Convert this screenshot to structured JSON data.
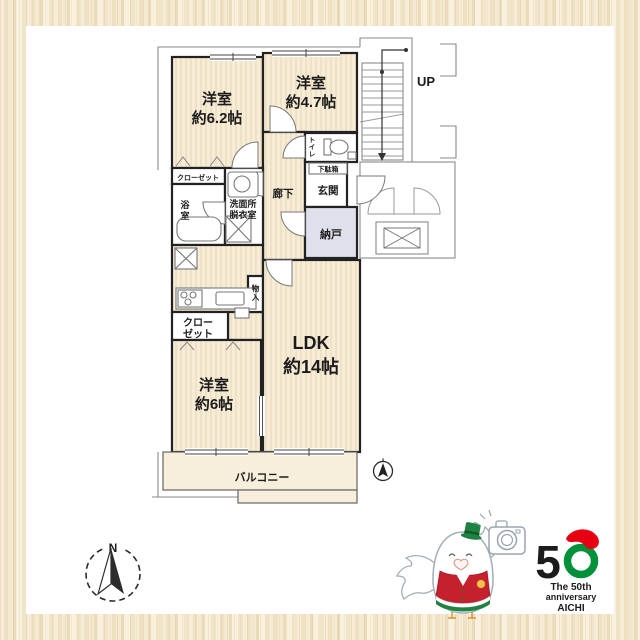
{
  "plan": {
    "rooms": {
      "bedroom1_l1": "洋室",
      "bedroom1_l2": "約6.2帖",
      "bedroom2_l1": "洋室",
      "bedroom2_l2": "約4.7帖",
      "bedroom3_l1": "洋室",
      "bedroom3_l2": "約6帖",
      "ldk_l1": "LDK",
      "ldk_l2": "約14帖",
      "hallway": "廊下",
      "entrance": "玄関",
      "shoebox": "下駄箱",
      "toilet_c1": "ト",
      "toilet_c2": "イ",
      "toilet_c3": "レ",
      "storage_nando": "納戸",
      "closet_top": "クローゼット",
      "closet_bottom_l1": "クロー",
      "closet_bottom_l2": "ゼット",
      "bath_c1": "浴",
      "bath_c2": "室",
      "washroom_l1": "洗面所",
      "washroom_l2": "脱衣室",
      "storage_small_c1": "物",
      "storage_small_c2": "入",
      "balcony": "バルコニー"
    },
    "stairs": {
      "up": "UP",
      "down": "DN"
    },
    "compass": {
      "north": "N"
    }
  },
  "branding": {
    "logo": {
      "number_5": "5",
      "line1": "The 50th",
      "line2": "anniversary",
      "line3": "AICHI"
    },
    "icons": {
      "mascot": "bird-mascot-with-camera-icon",
      "compass": "north-compass-icon",
      "mini_compass": "mini-north-indicator-icon"
    }
  },
  "colors": {
    "wood_light": "#f9f1de",
    "wood_mid": "#efe2c4",
    "wood_dark": "#eadcba",
    "room_fill": "#f8ecd7",
    "room_stripe": "#eadcbe",
    "nando_fill": "#e0dfec",
    "balcony_fill": "#f7efdc",
    "wall": "#222222",
    "thin_line": "#8a8a8a",
    "logo_red": "#e60012",
    "logo_green": "#00913a",
    "mascot_red": "#c5202e",
    "mascot_green": "#1e8240"
  }
}
